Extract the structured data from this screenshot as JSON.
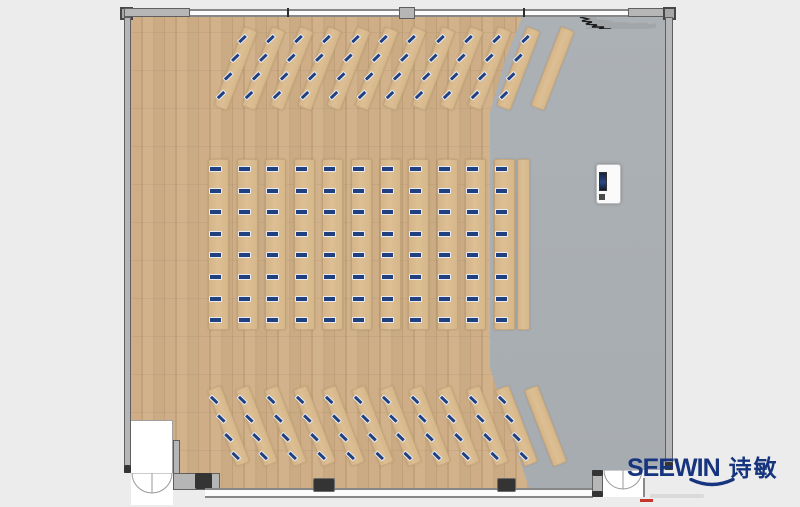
{
  "brand": {
    "name_latin": "SEEWIN",
    "name_cn": "诗敏",
    "color": "#16357e"
  },
  "palette": {
    "wood_floor": "#c9aa83",
    "gray_floor": "#aaafb3",
    "desk_top": "#d9ba8e",
    "seat_blue": "#21407f",
    "wall_gray": "#b6b6b6",
    "wall_outline": "#5f5f5f",
    "outside": "#ececec",
    "logo_blue": "#16357e"
  },
  "plan": {
    "seats_total": 176,
    "diagonal_sections": [
      {
        "id": "top-row",
        "angle": 21,
        "desk_count": 11,
        "plain_desk": true,
        "plain_center_x": 552,
        "first_center_x": 235,
        "step_x": 28.3,
        "center_y": 68,
        "desk_w": 15,
        "desk_len": 85,
        "seats_per_desk": 4,
        "seat_first": 7,
        "seat_step": 20,
        "seat_rot": 25
      },
      {
        "id": "bottom-row",
        "angle": -21,
        "desk_count": 11,
        "plain_desk": true,
        "plain_center_x": 545,
        "first_center_x": 228,
        "step_x": 28.8,
        "center_y": 426,
        "desk_w": 15,
        "desk_len": 82,
        "seats_per_desk": 4,
        "seat_first": 6,
        "seat_step": 20,
        "seat_rot": -25
      }
    ],
    "middle_section": {
      "id": "center-block",
      "desk_count": 11,
      "first_x": 208,
      "step_x": 28.6,
      "top_y": 159,
      "desk_w": 21,
      "desk_len": 171,
      "seats_per_desk": 8,
      "seat_first": 7,
      "seat_step": 21.6,
      "plain_desk": true,
      "plain_x": 517,
      "plain_w": 13
    }
  }
}
